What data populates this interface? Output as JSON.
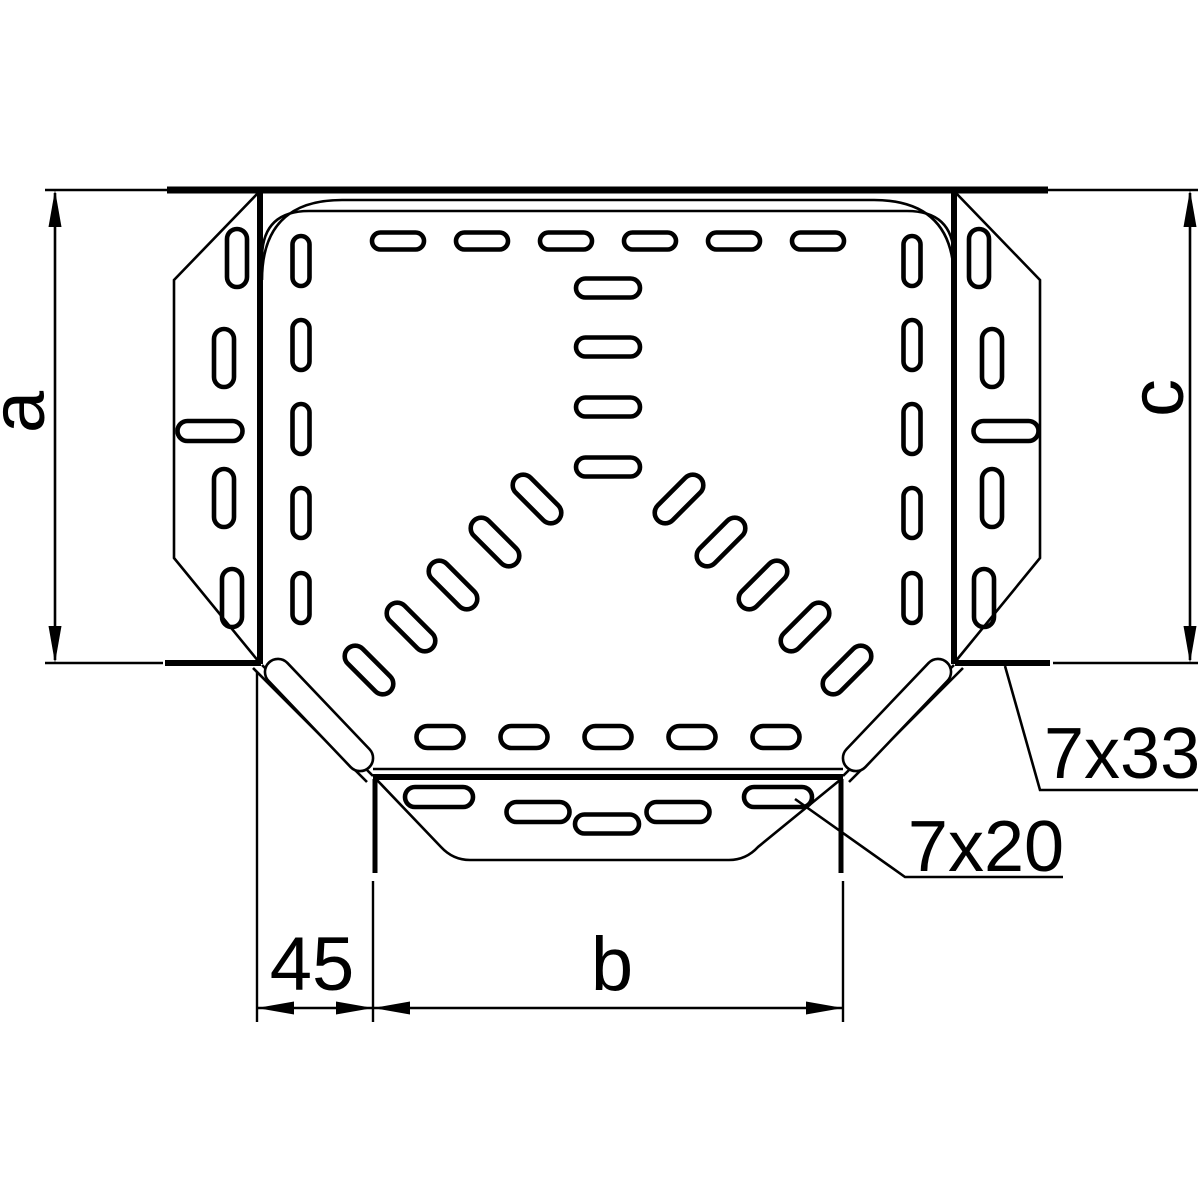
{
  "figure": {
    "type": "technical-drawing",
    "subject": "cable-tray tee piece, plan view with dimensions"
  },
  "colors": {
    "line": "#000000",
    "background": "#ffffff"
  },
  "labels": {
    "dim_left": "a",
    "dim_right": "c",
    "dim_bottom_offset": "45",
    "dim_bottom_width": "b",
    "callout_corner_slot": "7x33",
    "callout_end_slot": "7x20"
  },
  "drawing": {
    "thin_paths": [
      "M259,192 L174,280 L174,558 L259,662",
      "M955,192 L1040,280 L1040,558 L955,662",
      "M377,780 L441,847 Q453,860 470,860 L729,860 Q746,860 758,847 L840,780",
      "M262,280 Q262,200 342,200 L874,200 Q954,200 954,280",
      "M262,258 Q262,211 309,211 L907,211 Q954,211 954,258",
      "M373,769 L843,769",
      "M253,668 L367,782",
      "M262,665 L373,776",
      "M963,668 L849,782",
      "M954,665 L843,776"
    ],
    "thick_lines": [
      {
        "d": "M167,190 L1048,190",
        "w": 7
      },
      {
        "d": "M260,191 L260,664",
        "w": 6
      },
      {
        "d": "M954,191 L954,664",
        "w": 6
      },
      {
        "d": "M165,663 L261,663",
        "w": 6
      },
      {
        "d": "M955,663 L1050,663",
        "w": 6
      },
      {
        "d": "M373,777 L843,777",
        "w": 6
      },
      {
        "d": "M375,779 L375,873",
        "w": 5
      },
      {
        "d": "M841,779 L841,873",
        "w": 5
      }
    ],
    "corner_capsules": [
      {
        "cx": 319,
        "cy": 715,
        "len": 145,
        "wid": 26,
        "rot": 46.4
      },
      {
        "cx": 897,
        "cy": 715,
        "len": 145,
        "wid": 26,
        "rot": -46.4
      }
    ],
    "slot_groups": [
      {
        "name": "top-row",
        "w": 52,
        "h": 17,
        "rot": 0,
        "centers": [
          [
            398,
            241
          ],
          [
            482,
            241
          ],
          [
            566,
            241
          ],
          [
            650,
            241
          ],
          [
            734,
            241
          ],
          [
            818,
            241
          ]
        ]
      },
      {
        "name": "center-column",
        "w": 64,
        "h": 19,
        "rot": 0,
        "centers": [
          [
            608,
            288
          ],
          [
            608,
            347
          ],
          [
            608,
            407
          ],
          [
            608,
            467
          ]
        ]
      },
      {
        "name": "body-bottom-row",
        "w": 47,
        "h": 22,
        "rot": 0,
        "centers": [
          [
            440,
            737
          ],
          [
            524,
            737
          ],
          [
            608,
            737
          ],
          [
            692,
            737
          ],
          [
            776,
            737
          ]
        ]
      },
      {
        "name": "left-inner-column",
        "w": 17,
        "h": 50,
        "rot": 0,
        "centers": [
          [
            301,
            261
          ],
          [
            301,
            345
          ],
          [
            301,
            429
          ],
          [
            301,
            513
          ],
          [
            301,
            598
          ]
        ]
      },
      {
        "name": "right-inner-column",
        "w": 17,
        "h": 50,
        "rot": 0,
        "centers": [
          [
            912,
            261
          ],
          [
            912,
            345
          ],
          [
            912,
            429
          ],
          [
            912,
            513
          ],
          [
            912,
            598
          ]
        ]
      },
      {
        "name": "left-wing-slots",
        "w": 20,
        "h": 58,
        "rot": 0,
        "centers": [
          [
            237,
            258
          ],
          [
            224,
            358
          ],
          [
            224,
            498
          ],
          [
            232,
            598
          ]
        ]
      },
      {
        "name": "left-wing-horizontal",
        "w": 65,
        "h": 20,
        "rot": 0,
        "centers": [
          [
            210,
            431
          ]
        ]
      },
      {
        "name": "right-wing-slots",
        "w": 20,
        "h": 58,
        "rot": 0,
        "centers": [
          [
            979,
            258
          ],
          [
            992,
            358
          ],
          [
            992,
            498
          ],
          [
            984,
            598
          ]
        ]
      },
      {
        "name": "right-wing-horizontal",
        "w": 65,
        "h": 20,
        "rot": 0,
        "centers": [
          [
            1006,
            431
          ]
        ]
      },
      {
        "name": "left-diagonal-arm",
        "w": 60,
        "h": 21,
        "rot": 45,
        "centers": [
          [
            537,
            499
          ],
          [
            495,
            542
          ],
          [
            453,
            585
          ],
          [
            411,
            627
          ],
          [
            369,
            670
          ]
        ]
      },
      {
        "name": "right-diagonal-arm",
        "w": 60,
        "h": 21,
        "rot": -45,
        "centers": [
          [
            679,
            499
          ],
          [
            721,
            542
          ],
          [
            763,
            585
          ],
          [
            805,
            627
          ],
          [
            847,
            670
          ]
        ]
      },
      {
        "name": "end-flange-slots",
        "w": 68,
        "h": 20,
        "rot": 0,
        "centers": [
          [
            439,
            797
          ],
          [
            778,
            797
          ]
        ]
      },
      {
        "name": "end-flange-slots-inner",
        "w": 63,
        "h": 20,
        "rot": 0,
        "centers": [
          [
            538,
            812
          ],
          [
            678,
            812
          ]
        ]
      },
      {
        "name": "end-flange-center-slot",
        "w": 19,
        "h": 64,
        "rot": 90,
        "centers": [
          [
            607,
            824
          ]
        ]
      }
    ],
    "extension_lines": [
      "M45,190 L170,190",
      "M45,663 L163,663",
      "M1048,190 L1198,190",
      "M1053,663 L1198,663",
      "M257,672 L257,1022",
      "M373,881 L373,1022",
      "M843,881 L843,1022"
    ],
    "dimension_lines": [
      "M55,193 L55,660",
      "M1190,193 L1190,660",
      "M257,1008 L843,1008"
    ],
    "arrows": [
      {
        "x": 55,
        "y": 190,
        "dir": "up"
      },
      {
        "x": 55,
        "y": 663,
        "dir": "down"
      },
      {
        "x": 1190,
        "y": 190,
        "dir": "up"
      },
      {
        "x": 1190,
        "y": 663,
        "dir": "down"
      },
      {
        "x": 257,
        "y": 1008,
        "dir": "left"
      },
      {
        "x": 373,
        "y": 1008,
        "dir": "right"
      },
      {
        "x": 373,
        "y": 1008,
        "dir": "left"
      },
      {
        "x": 843,
        "y": 1008,
        "dir": "right"
      }
    ],
    "leader_lines": [
      "M1005,666 L1040,790 L1198,790",
      "M795,799 L905,877 L1063,877"
    ]
  }
}
